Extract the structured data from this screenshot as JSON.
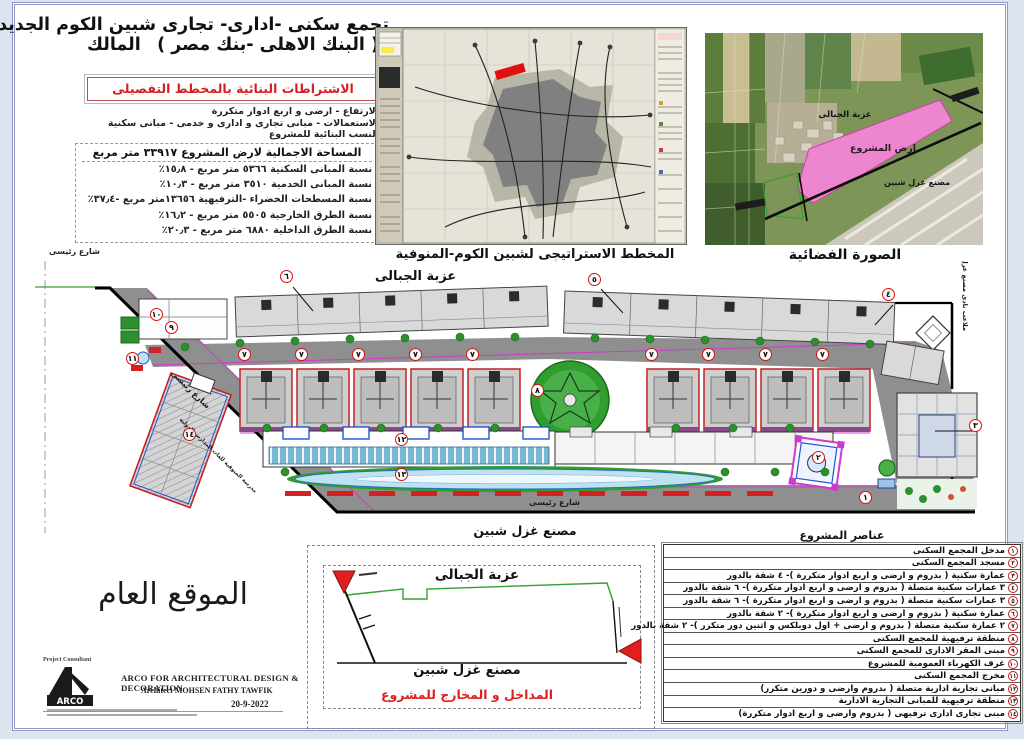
{
  "header": {
    "title_line1": "تجمع سكنى -ادارى- تجارى شبين الكوم الجديدة",
    "owner_label": "المالك",
    "owner_value": "( البنك الاهلى -بنك مصر )"
  },
  "requirements": {
    "box_title": "الاشتراطات البنائية بالمخطط التفصيلى",
    "lines": [
      "الارتفاع - ارضى و اربع ادوار متكررة",
      "الاستعمالات - مبانى تجارى و ادارى و خدمى - مبانى سكنية",
      "النسب البنائية للمشروع"
    ]
  },
  "areas_table": {
    "header": "المساحة الاجمالية لارض المشروع ٣٣٩١٧ متر مربع",
    "rows": [
      "نسبة المبانى السكنية ٥٣٦٦ متر مربع - ١٥٫٨٪",
      "نسبة المبانى الخدمية ٣٥١٠ متر مربع - ١٠٫٣٪",
      "نسبة المسطحات الخضراء -الترفيهية ١٣٦٥٦متر مربع -٣٧٫٤٪",
      "نسبة الطرق الخارجية ٥٥٠٥ متر مربع - ١٦٫٢٪",
      "نسبة الطرق الداخلية ٦٨٨٠ متر مربع - ٢٠٫٣٪"
    ]
  },
  "strategic_map": {
    "caption": "المخطط الاستراتيجى لشبين الكوم-المنوفية"
  },
  "aerial": {
    "caption": "الصورة الفضائية",
    "village_label": "عزبة الجبالى",
    "site_label": "ارض المشروع",
    "factory_label": "مصنع غزل شبين"
  },
  "site_plan": {
    "village_label": "عزبة الجبالى",
    "street_topleft_label": "شارع رئيسى",
    "street_left_label": "شارع رئيسى",
    "school_label": "مدرسة المنوفية للغات المدارس الدولية",
    "street_bottom_label": "شارع رئيسى",
    "club_label": "ملاعب نادى مصنع غزل شبين",
    "factory_label": "مصنع غزل شبين",
    "markers": [
      {
        "label": "١",
        "x": 830,
        "y": 236
      },
      {
        "label": "٢",
        "x": 783,
        "y": 196
      },
      {
        "label": "٣",
        "x": 940,
        "y": 164
      },
      {
        "label": "٤",
        "x": 853,
        "y": 33
      },
      {
        "label": "٥",
        "x": 559,
        "y": 18
      },
      {
        "label": "٦",
        "x": 251,
        "y": 15
      },
      {
        "label": "٧",
        "x": 209,
        "y": 93
      },
      {
        "label": "٧",
        "x": 266,
        "y": 93
      },
      {
        "label": "٧",
        "x": 323,
        "y": 93
      },
      {
        "label": "٧",
        "x": 380,
        "y": 93
      },
      {
        "label": "٧",
        "x": 437,
        "y": 93
      },
      {
        "label": "٧",
        "x": 616,
        "y": 93
      },
      {
        "label": "٧",
        "x": 673,
        "y": 93
      },
      {
        "label": "٧",
        "x": 730,
        "y": 93
      },
      {
        "label": "٧",
        "x": 787,
        "y": 93
      },
      {
        "label": "٨",
        "x": 502,
        "y": 129
      },
      {
        "label": "٩",
        "x": 136,
        "y": 66
      },
      {
        "label": "١٠",
        "x": 121,
        "y": 53
      },
      {
        "label": "١١",
        "x": 97,
        "y": 97
      },
      {
        "label": "١٢",
        "x": 366,
        "y": 178
      },
      {
        "label": "١٣",
        "x": 366,
        "y": 213
      },
      {
        "label": "١٤",
        "x": 154,
        "y": 173
      }
    ]
  },
  "entrances_box": {
    "village_label": "عزبة الجبالى",
    "factory_label": "مصنع غزل شبين",
    "caption": "المداخل و المخارج للمشروع"
  },
  "general_site": {
    "title": "الموقع العام"
  },
  "consultant": {
    "role": "Project   Consultant",
    "logo_text": "ARCO",
    "line1": "ARCO FOR ARCHITECTURAL DESIGN & DECORATION",
    "line2": "Architect MOHSEN FATHY TAWFIK",
    "date": "20-9-2022"
  },
  "elements_table": {
    "header": "عناصر المشروع",
    "rows": [
      {
        "num": "١",
        "text": "مدخل المجمع السكنى"
      },
      {
        "num": "٢",
        "text": "مسجد المجمع السكنى"
      },
      {
        "num": "٣",
        "text": "عمارة سكنية ( بدروم و ارضى و اربع ادوار متكررة )- ٤ شقة بالدور"
      },
      {
        "num": "٤",
        "text": "٣ عمارات سكنية متصلة ( بدروم و ارضى و اربع ادوار متكررة )- ٦ شقة بالدور"
      },
      {
        "num": "٥",
        "text": "٣ عمارات سكنية متصلة ( بدروم و ارضى و اربع ادوار متكررة )- ٦ شقة بالدور"
      },
      {
        "num": "٦",
        "text": "عمارة سكنية ( بدروم و ارضى و اربع ادوار متكررة )- ٢ شقة بالدور"
      },
      {
        "num": "٧",
        "text": "٢ عمارة سكنية متصلة ( بدروم و ارضى + اول دوبلكس و اثنين دور متكرر )- ٢ شقة بالدور"
      },
      {
        "num": "٨",
        "text": "منطقة ترفيهية للمجمع السكنى"
      },
      {
        "num": "٩",
        "text": "مبنى المقر الادارى للمجمع السكنى"
      },
      {
        "num": "١٠",
        "text": "غرف الكهرباء العمومية للمشروع"
      },
      {
        "num": "١١",
        "text": "مخرج المجمع السكنى"
      },
      {
        "num": "١٢",
        "text": "مبانى تجارية ادارية متصلة ( بدروم وارضى و دورين متكرر)"
      },
      {
        "num": "١٣",
        "text": "منطقة ترفيهية للمبانى التجارية الادارية"
      },
      {
        "num": "١٤",
        "text": "مبنى تجارى ادارى ترفيهى ( بدروم وارضى و اربع ادوار متكررة)"
      }
    ]
  },
  "colors": {
    "site_pink": "#ee86cf",
    "accent_red": "#d42020",
    "road_gray": "#8f8f8f",
    "green": "#2f9e2f",
    "cad_magenta": "#cc3ccc",
    "water_blue": "#bfe2f2"
  }
}
